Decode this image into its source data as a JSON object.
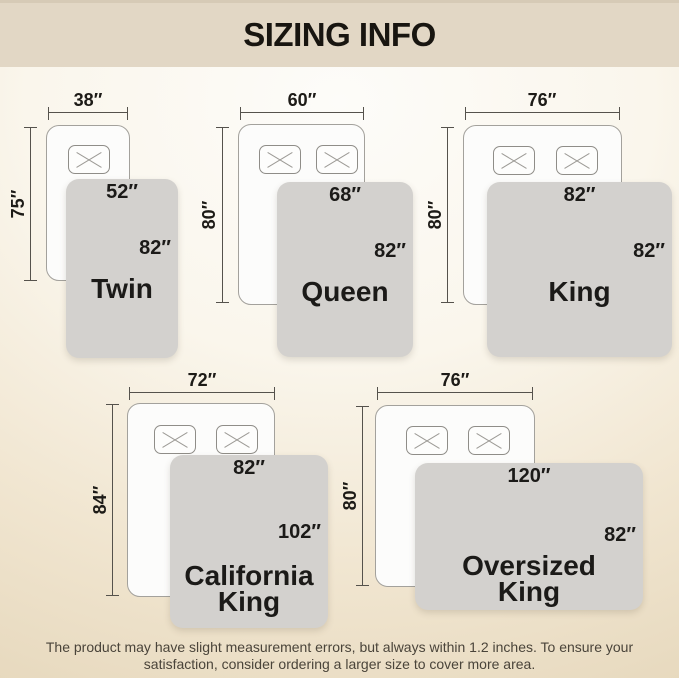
{
  "title": "SIZING INFO",
  "footer": {
    "line1": "The product may have slight measurement errors, but always within 1.2 inches. To ensure your",
    "line2": "satisfaction, consider ordering a larger size to cover more area."
  },
  "colors": {
    "header_bg": "#e2d7c5",
    "background_top": "#fdfcf9",
    "background_bottom": "#e7d9be",
    "blanket_gray": "#d3d1ce",
    "mattress_white": "#fcfcfb",
    "dimension_line": "#55524c",
    "text_dark": "#1b1a18"
  },
  "diagrams": [
    {
      "name": "Twin",
      "mattress_width": "38″",
      "mattress_height": "75″",
      "blanket_width": "52″",
      "blanket_length": "82″",
      "pillows": 1
    },
    {
      "name": "Queen",
      "mattress_width": "60″",
      "mattress_height": "80″",
      "blanket_width": "68″",
      "blanket_length": "82″",
      "pillows": 2
    },
    {
      "name": "King",
      "mattress_width": "76″",
      "mattress_height": "80″",
      "blanket_width": "82″",
      "blanket_length": "82″",
      "pillows": 2
    },
    {
      "name": "California King",
      "mattress_width": "72″",
      "mattress_height": "84″",
      "blanket_width": "82″",
      "blanket_length": "102″",
      "pillows": 2
    },
    {
      "name": "Oversized King",
      "mattress_width": "76″",
      "mattress_height": "80″",
      "blanket_width": "120″",
      "blanket_length": "82″",
      "pillows": 2
    }
  ]
}
